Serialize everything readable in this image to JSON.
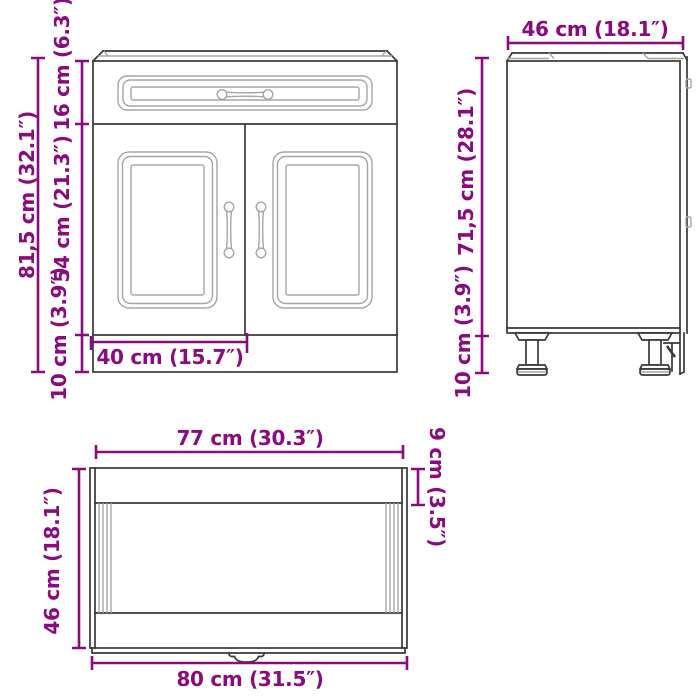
{
  "title": "Kitchen base cabinet dimension diagram",
  "colors": {
    "dimension": "#8a0b7d",
    "outline": "#383838",
    "detail": "#a5a5a5",
    "background": "#ffffff"
  },
  "front_view": {
    "total_height": "81,5 cm (32.1″)",
    "drawer_height": "16 cm (6.3″)",
    "doors_height": "54 cm (21.3″)",
    "plinth_height": "10 cm (3.9″)",
    "door_width": "40 cm (15.7″)"
  },
  "side_view": {
    "depth": "46 cm (18.1″)",
    "body_height": "71,5 cm (28.1″)",
    "leg_height": "10 cm (3.9″)"
  },
  "top_view": {
    "inner_width": "77 cm (30.3″)",
    "front_edge_depth": "9 cm (3.5″)",
    "depth": "46 cm (18.1″)",
    "outer_width": "80 cm (31.5″)"
  }
}
